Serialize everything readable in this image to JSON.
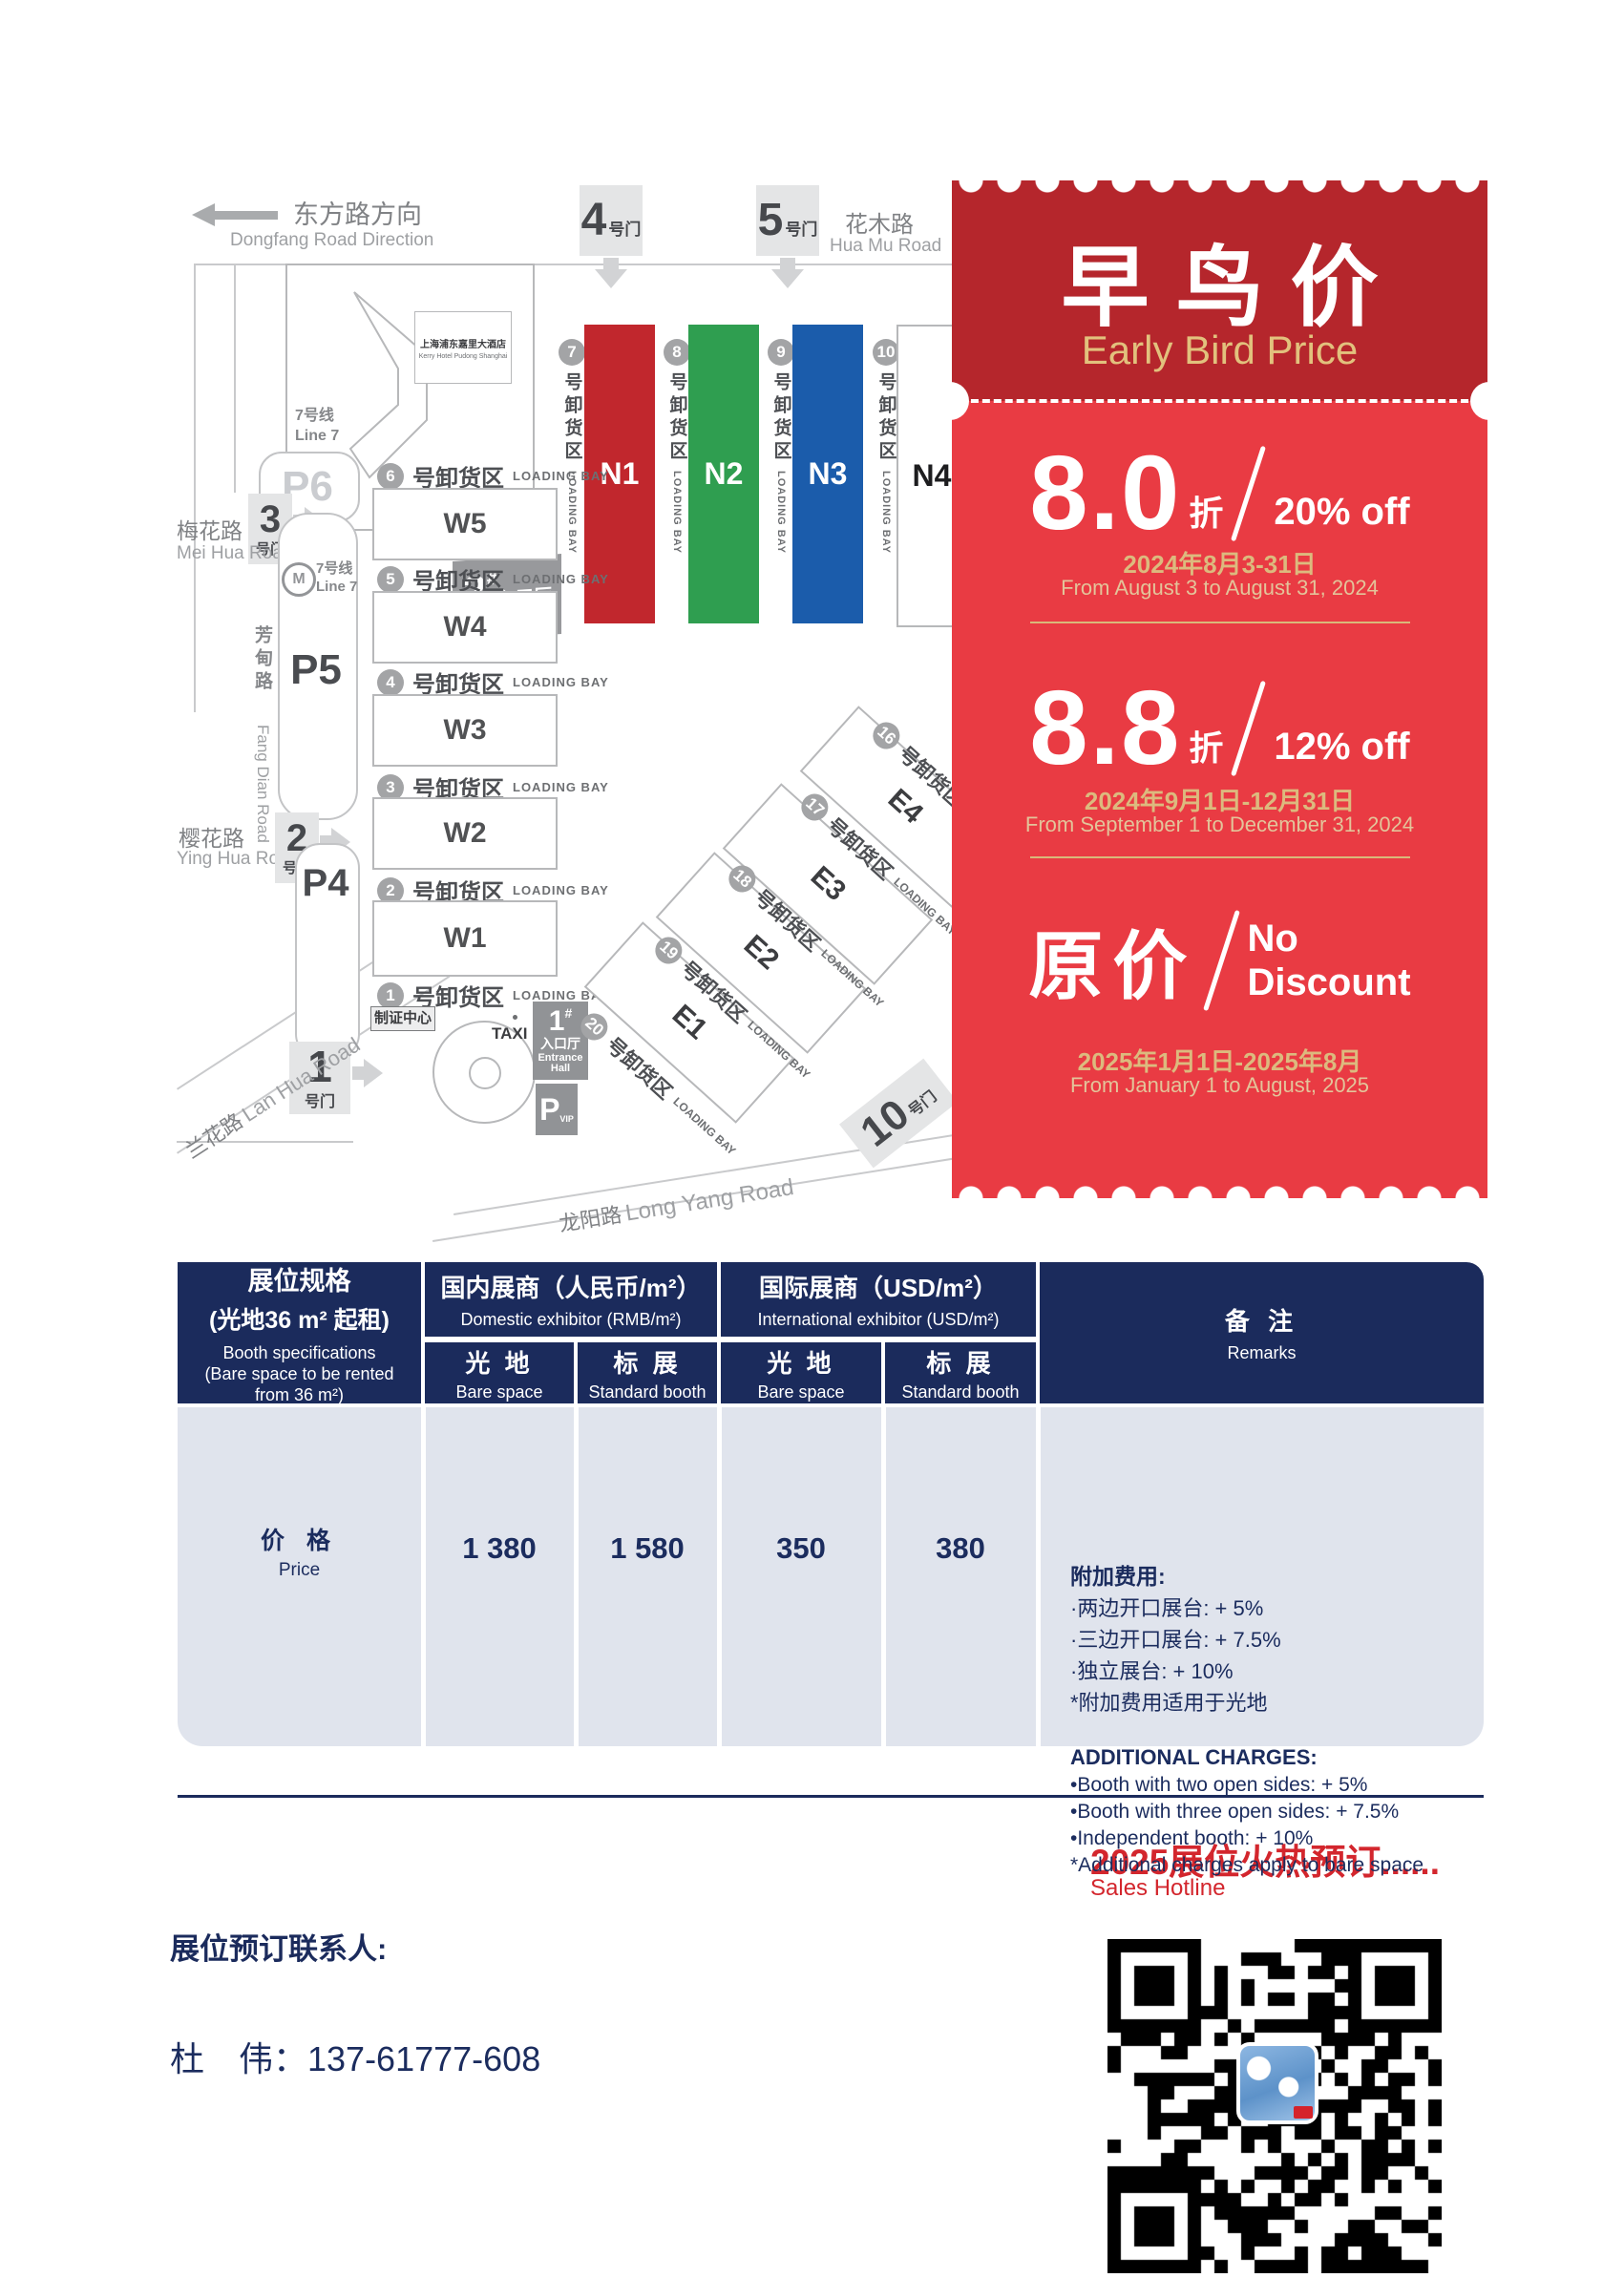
{
  "colors": {
    "navy": "#1b2b5c",
    "coupon_dark_red": "#b5262c",
    "coupon_red": "#e93b43",
    "gold": "#dcba7e",
    "hall_red": "#c1272d",
    "hall_green": "#2f9e50",
    "hall_blue": "#1b5cab",
    "table_row_bg": "#e0e4ed",
    "footer_red": "#d3262d"
  },
  "map": {
    "direction": {
      "zh": "东方路方向",
      "en": "Dongfang Road Direction"
    },
    "gate_suffix": "号门",
    "top_gates": [
      "4",
      "5"
    ],
    "left_gates": [
      "3",
      "2",
      "1"
    ],
    "gate_bottom": "10",
    "roads": {
      "huamu_zh": "花木路",
      "huamu_en": "Hua Mu Road",
      "meihua_zh": "梅花路",
      "meihua_en": "Mei Hua Road",
      "yinghua_zh": "樱花路",
      "yinghua_en": "Ying Hua Road",
      "fangdian_zh": "芳甸路",
      "fangdian_en": "Fang Dian Road",
      "lanhua_zh": "兰花路",
      "lanhua_en": "Lan Hua Road",
      "longyang_zh": "龙阳路",
      "longyang_en": "Long Yang Road"
    },
    "hotel_zh": "上海浦东嘉里大酒店",
    "hotel_en": "Kerry Hotel Pudong Shanghai",
    "metro_zh": "7号线",
    "metro_en": "Line 7",
    "metro_m": "M",
    "entrance_hash": "#",
    "entrance_zh": "入口厅",
    "entrance_en": "Entrance Hall",
    "entrance2_num": "2",
    "entrance1_num": "1",
    "entrance1_en1": "Entrance",
    "entrance1_en2": "Hall",
    "loading_zh": "号卸货区",
    "loading_en": "LOADING BAY",
    "n_halls": [
      {
        "label": "N1",
        "bay": "7"
      },
      {
        "label": "N2",
        "bay": "8"
      },
      {
        "label": "N3",
        "bay": "9"
      },
      {
        "label": "N4",
        "bay": "10"
      }
    ],
    "w_halls": [
      {
        "label": "W5",
        "bay": "6"
      },
      {
        "label": "W4",
        "bay": "5"
      },
      {
        "label": "W3",
        "bay": "4"
      },
      {
        "label": "W2",
        "bay": "3"
      },
      {
        "label": "W1",
        "bay": "2"
      }
    ],
    "w_last_bay": "1",
    "e_halls": [
      {
        "label": "E4",
        "bay": "16"
      },
      {
        "label": "E3",
        "bay": "17"
      },
      {
        "label": "E2",
        "bay": "18"
      },
      {
        "label": "E1",
        "bay": "19"
      }
    ],
    "e_last_bay": "20",
    "parking": [
      "P6",
      "P5",
      "P4"
    ],
    "vip_p": "P",
    "vip": "VIP",
    "badge_center": "制证中心",
    "taxi": "TAXI"
  },
  "coupon": {
    "title_zh": "早鸟价",
    "title_en": "Early Bird Price",
    "tiers": [
      {
        "big": "8.0",
        "unit": "折",
        "off": "20% off",
        "date_zh": "2024年8月3-31日",
        "date_en": "From August 3 to August 31, 2024"
      },
      {
        "big": "8.8",
        "unit": "折",
        "off": "12% off",
        "date_zh": "2024年9月1日-12月31日",
        "date_en": "From September 1 to December 31, 2024"
      },
      {
        "big": "原价",
        "off_line1": "No",
        "off_line2": "Discount",
        "date_zh": "2025年1月1日-2025年8月",
        "date_en": "From January 1 to August, 2025"
      }
    ]
  },
  "table": {
    "col1": {
      "zh1": "展位规格",
      "zh2": "(光地36 m² 起租)",
      "en1": "Booth specifications",
      "en2": "(Bare space to be rented",
      "en3": "from 36 m²)"
    },
    "groups": [
      {
        "zh": "国内展商（人民币/m²）",
        "en": "Domestic exhibitor (RMB/m²)"
      },
      {
        "zh": "国际展商（USD/m²）",
        "en": "International exhibitor (USD/m²)"
      }
    ],
    "subcols": [
      {
        "zh": "光 地",
        "en": "Bare space"
      },
      {
        "zh": "标 展",
        "en": "Standard booth"
      },
      {
        "zh": "光 地",
        "en": "Bare space"
      },
      {
        "zh": "标 展",
        "en": "Standard booth"
      }
    ],
    "remarks_header": {
      "zh": "备 注",
      "en": "Remarks"
    },
    "row": {
      "label_zh": "价 格",
      "label_en": "Price",
      "values": [
        "1 380",
        "1 580",
        "350",
        "380"
      ]
    },
    "remarks": {
      "zh_title": "附加费用:",
      "zh_items": [
        "·两边开口展台: + 5%",
        "·三边开口展台: + 7.5%",
        "·独立展台: + 10%",
        "*附加费用适用于光地"
      ],
      "en_title": "ADDITIONAL CHARGES:",
      "en_items": [
        "•Booth with two open sides: + 5%",
        "•Booth with three open sides: + 7.5%",
        "•Independent booth: + 10%",
        "*Additional charges apply to bare space"
      ]
    }
  },
  "footer": {
    "hotline_zh": "2025展位火热预订......",
    "hotline_en": "Sales Hotline",
    "contact_label": "展位预订联系人:",
    "contact": "杜　伟：137-61777-608"
  }
}
